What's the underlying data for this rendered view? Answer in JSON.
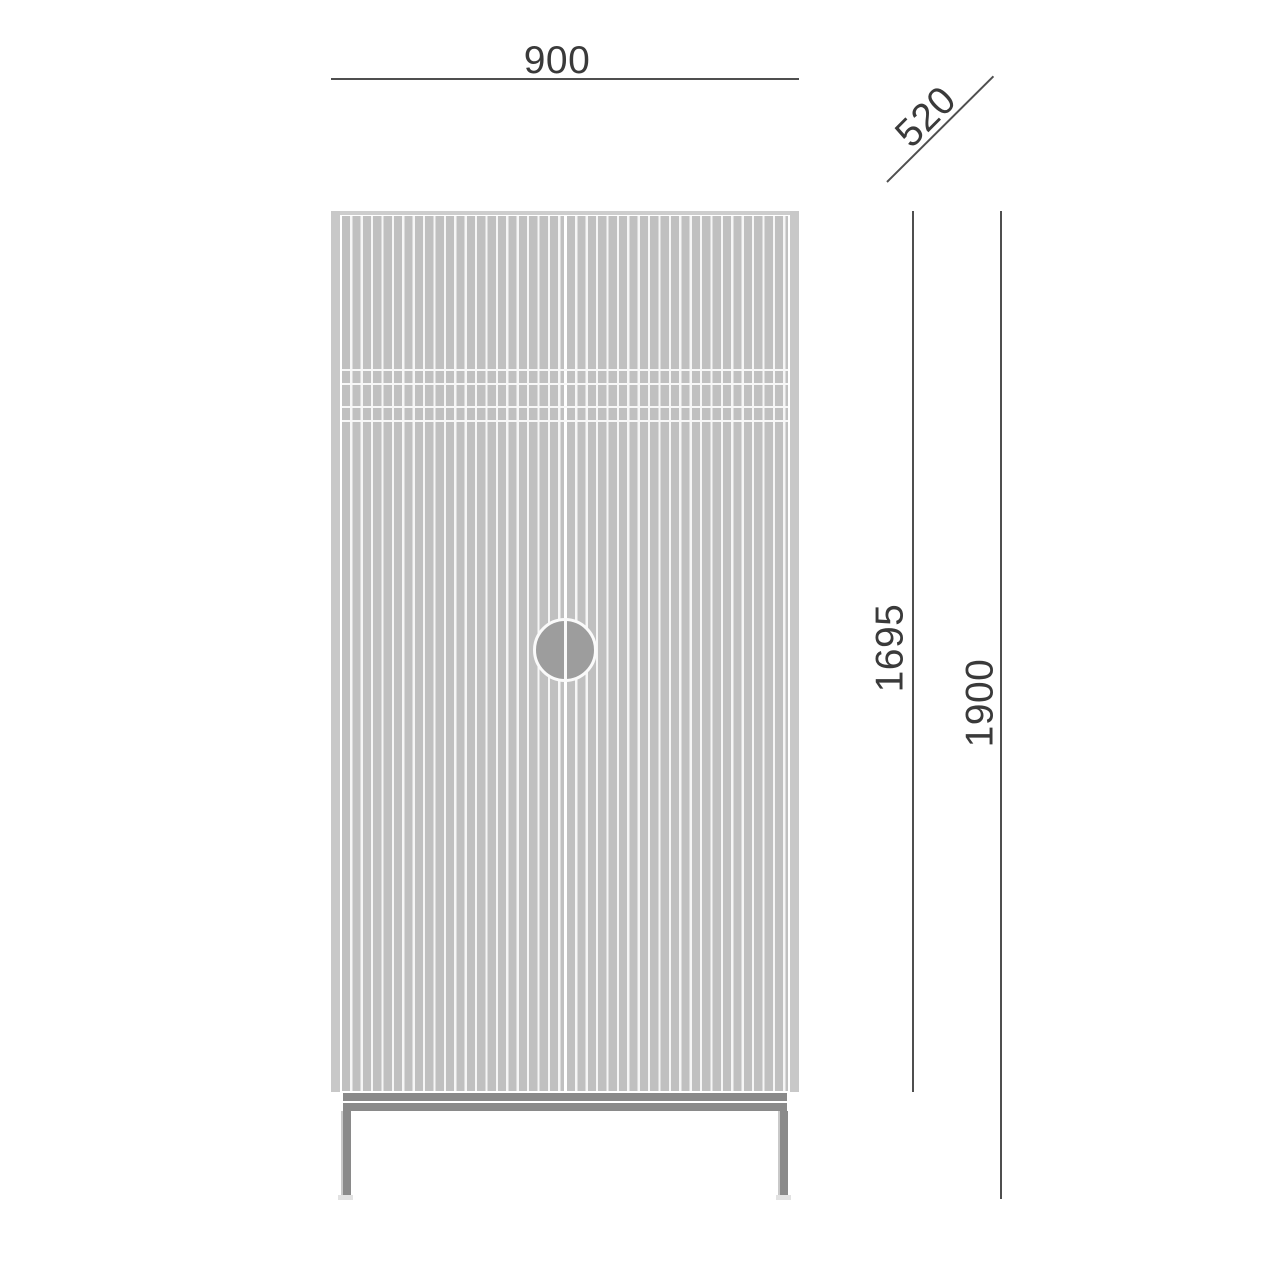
{
  "drawing": {
    "dimensions": {
      "width_mm": "900",
      "depth_mm": "520",
      "body_height_mm": "1695",
      "total_height_mm": "1900"
    },
    "colors": {
      "bg": "#ffffff",
      "slat": "#c0c0c0",
      "gap": "#f6f6f6",
      "edge": "#c8c8c8",
      "top": "#cdcdcd",
      "base": "#8a8a8a",
      "handle": "#9d9d9d",
      "foot": "#e2e2e2",
      "dim": "#4f4f4f",
      "text": "#3a3a3a"
    }
  }
}
